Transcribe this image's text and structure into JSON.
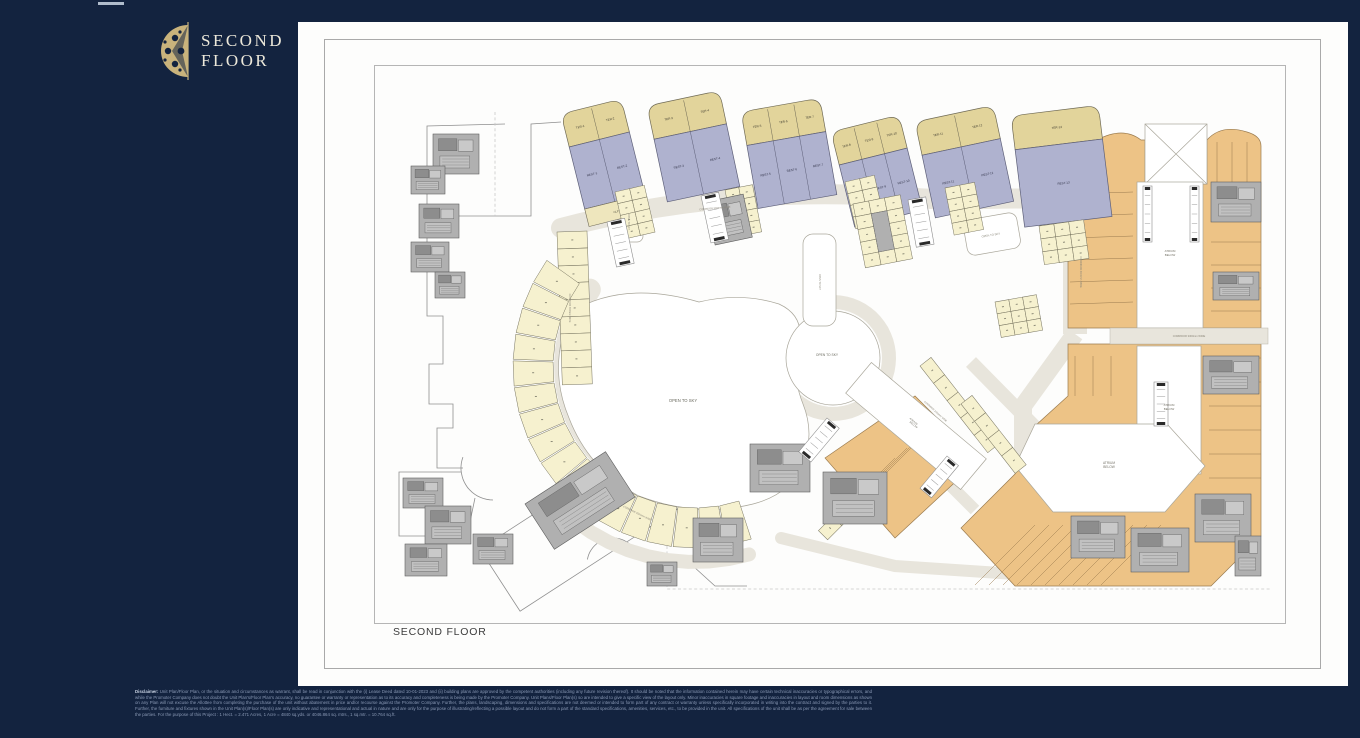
{
  "header": {
    "window_dash": "",
    "logo": {
      "title_line1": "SECOND",
      "title_line2": "FLOOR"
    }
  },
  "plan": {
    "caption": "SECOND FLOOR",
    "labels": {
      "open_to_sky": "OPEN TO SKY",
      "atrium_line1": "ATRIUM",
      "atrium_line2": "BELOW",
      "corridor_3000": "CORRIDOR 3000mm WIDE",
      "corridor_3300": "CORRIDOR 3300mm WIDE",
      "corridor_2450": "CORRIDOR 2450mm WIDE",
      "strip_unit": "CLP 1"
    },
    "clusters": [
      {
        "ter": [
          "TER-1",
          "TER-2"
        ],
        "rest": [
          "REST-1",
          "REST-2"
        ]
      },
      {
        "ter": [
          "TER-3",
          "TER-4"
        ],
        "rest": [
          "REST-3",
          "REST-4"
        ]
      },
      {
        "ter": [
          "TER-5",
          "TER-6",
          "TER-7"
        ],
        "rest": [
          "REST-5",
          "REST-6",
          "REST-7"
        ]
      },
      {
        "ter": [
          "TER-8",
          "TER-9",
          "TER-10"
        ],
        "rest": [
          "REST-8",
          "REST-9",
          "REST-10"
        ]
      },
      {
        "ter": [
          "TER-11",
          "TER-12"
        ],
        "rest": [
          "REST-11",
          "REST-12"
        ]
      },
      {
        "ter": [
          "TER-13"
        ],
        "rest": [
          "REST-13"
        ]
      }
    ]
  },
  "disclaimer": {
    "label": "Disclaimer:",
    "body": "Unit Plan/Floor Plan, or the situation and circumstances as warrant, shall be read in conjunction with the (i) Lease Deed dated 10-01-2023 and (ii) building plans are approved by the competent authorities (including any future revision thereof). It should be noted that the information contained herein may have certain technical inaccuracies or typographical errors, and while the Promoter Company does not doubt the Unit Plan's/Floor Plan's accuracy, no guarantee or warranty or representation as to its accuracy and completeness is being made by the Promoter Company. Unit Plans/Floor Plan(s) so are intended to give a specific view of the layout only. Minor inaccuracies in square footage and inaccuracies in layout and room dimensions as shown on any Plan will not excuse the Allottee from completing the purchase of the unit without abatement in price and/or recourse against the Promoter Company. Further, the plans, landscaping, dimensions and specifications are not deemed or intended to form part of any contract or warranty unless specifically incorporated in writing into the contract and signed by the parties to it. Further, the furniture and fixtures shown in the Unit Plan(s)/Floor Plan(s) are only indicative and representational and actual in nature and are only for the purpose of illustrating/reflecting a possible layout and do not form a part of the standard specifications, amenities, services, etc., to be provided in the unit. All specifications of the unit shall be as per the agreement for sale between the parties. For the purpose of this Project : 1 Hect. = 2.471 Acres, 1 Acre = 4840 sq.yds. or 4046.864 sq. mtrs., 1 sq.mtr. = 10.764 sq.ft."
  },
  "colors": {
    "background_navy": "#13233f",
    "logo_gold": "#c9b37c",
    "logo_text": "#ece8da",
    "unit_terrace_beige": "#e2d49b",
    "unit_restaurant_lavender": "#afb2cf",
    "unit_small_yellow": "#f6f1cf",
    "unit_retail_orange": "#edc386",
    "corridor_grey": "#e8e5dc",
    "technical_grey": "#b0b0b0",
    "open_white": "#ffffff"
  }
}
